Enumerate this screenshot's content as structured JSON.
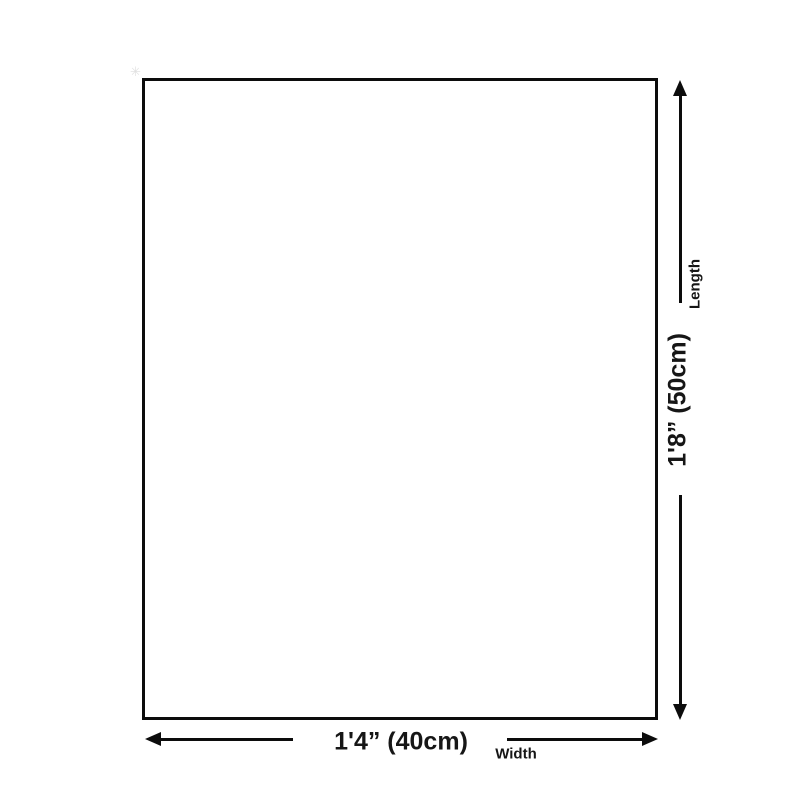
{
  "figure": {
    "type": "product-dimension-diagram",
    "background_color": "#ffffff",
    "line_color": "#0c0c0c",
    "text_color": "#161616"
  },
  "dimensions": {
    "length": {
      "value": "1'8” (50cm)",
      "label": "Length"
    },
    "width": {
      "value": "1'4” (40cm)",
      "label": "Width"
    }
  },
  "decorations": {
    "corner_sparkle": "✳"
  }
}
